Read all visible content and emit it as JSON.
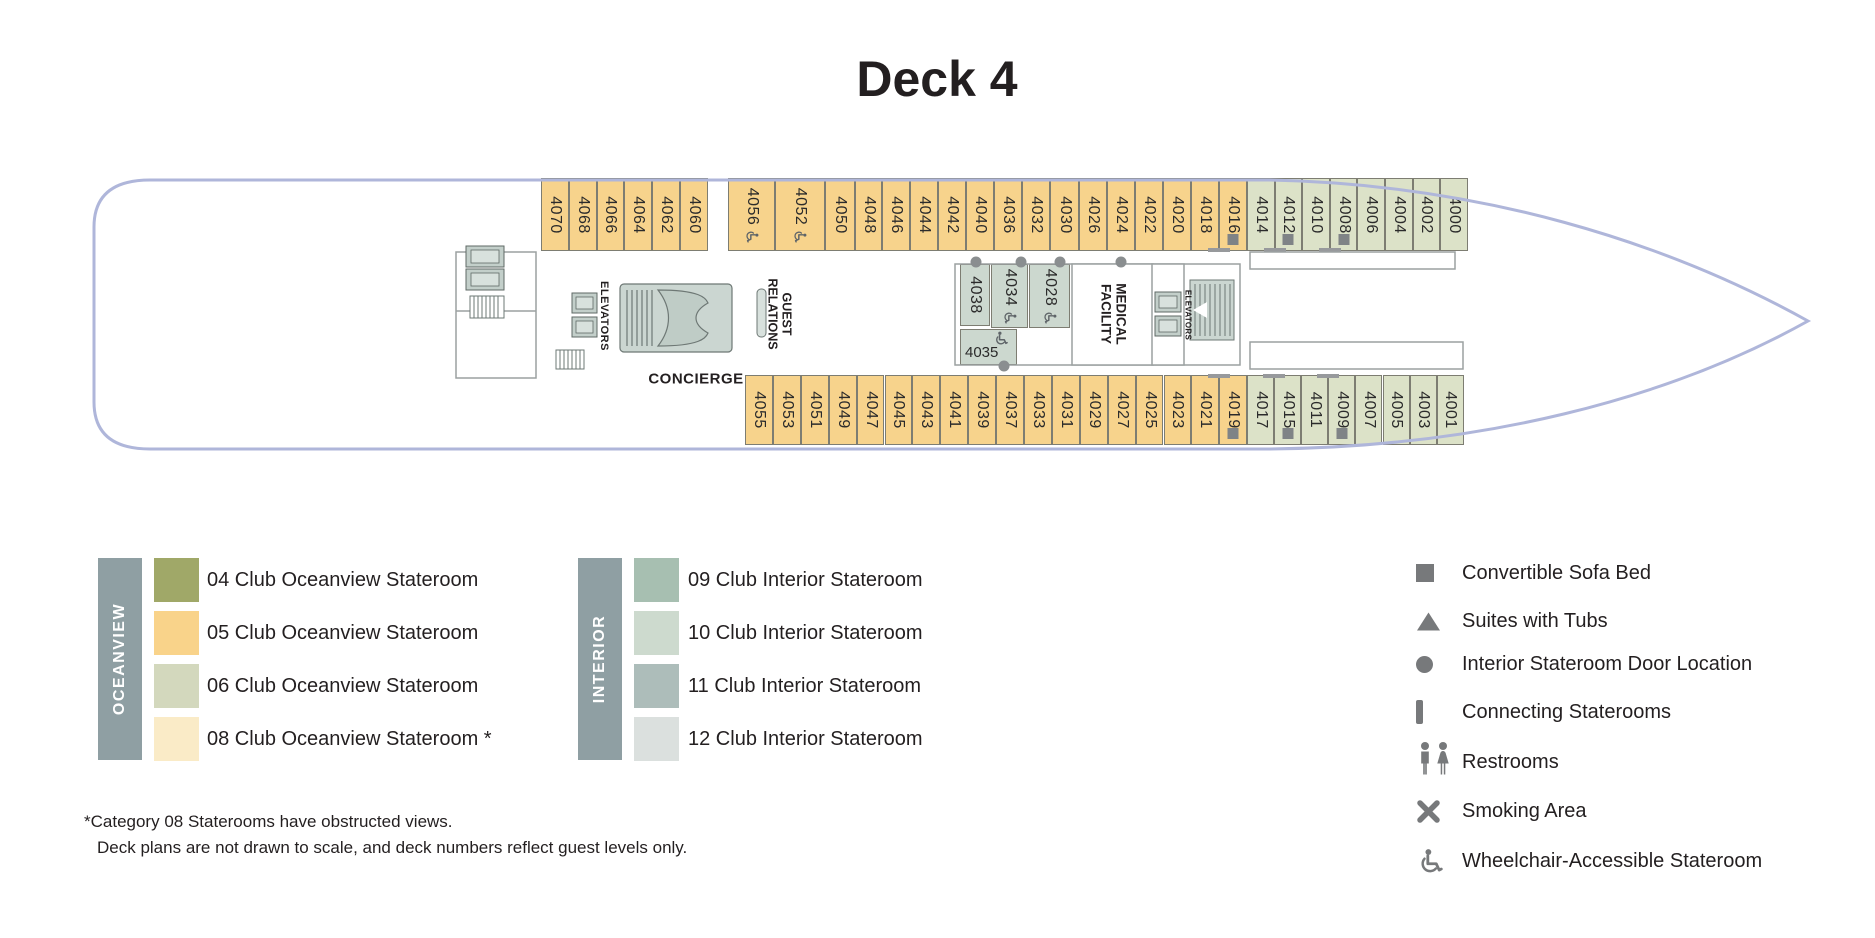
{
  "header": {
    "title": "Deck 4"
  },
  "colors": {
    "cat05": "#F7D38C",
    "cat06": "#DCE2C8",
    "cat10": "#CCD8CF",
    "hull": "#AFB6DA",
    "wall": "#9BA1A1",
    "marker_grey": "#7F8386",
    "legend_grey": "#77797B",
    "group_bar": "#8F9FA3"
  },
  "ship": {
    "labels": {
      "elevators_left": "ELEVATORS",
      "elevators_right": "ELEVATORS",
      "guest_relations": "GUEST RELATIONS",
      "concierge": "CONCIERGE",
      "medical_facility": "MEDICAL FACILITY"
    },
    "top_row_sections": [
      {
        "category": "05",
        "rooms": [
          {
            "number": "4070"
          },
          {
            "number": "4068"
          },
          {
            "number": "4066"
          },
          {
            "number": "4064"
          },
          {
            "number": "4062"
          },
          {
            "number": "4060"
          }
        ]
      },
      {
        "category": "05",
        "rooms": [
          {
            "number": "4056",
            "features": [
              "wheelchair"
            ]
          },
          {
            "number": "4052",
            "features": [
              "wheelchair"
            ]
          },
          {
            "number": "4050"
          },
          {
            "number": "4048"
          }
        ]
      },
      {
        "category": "05",
        "rooms": [
          {
            "number": "4046"
          },
          {
            "number": "4044"
          },
          {
            "number": "4042"
          },
          {
            "number": "4040"
          },
          {
            "number": "4036"
          },
          {
            "number": "4032"
          },
          {
            "number": "4030"
          },
          {
            "number": "4026"
          },
          {
            "number": "4024"
          },
          {
            "number": "4022"
          },
          {
            "number": "4020"
          },
          {
            "number": "4018"
          },
          {
            "number": "4016",
            "features": [
              "sofa",
              "connect-left"
            ]
          }
        ]
      },
      {
        "category": "06",
        "rooms": [
          {
            "number": "4014"
          },
          {
            "number": "4012",
            "features": [
              "sofa",
              "connect-left"
            ]
          },
          {
            "number": "4010"
          },
          {
            "number": "4008",
            "features": [
              "sofa",
              "connect-left"
            ]
          },
          {
            "number": "4006"
          },
          {
            "number": "4004"
          },
          {
            "number": "4002"
          },
          {
            "number": "4000"
          }
        ]
      }
    ],
    "bottom_row_sections": [
      {
        "category": "05",
        "rooms": [
          {
            "number": "4055"
          },
          {
            "number": "4053"
          },
          {
            "number": "4051"
          },
          {
            "number": "4049"
          },
          {
            "number": "4047"
          },
          {
            "number": "4045"
          },
          {
            "number": "4043"
          },
          {
            "number": "4041"
          },
          {
            "number": "4039"
          },
          {
            "number": "4037"
          },
          {
            "number": "4033"
          },
          {
            "number": "4031"
          },
          {
            "number": "4029"
          },
          {
            "number": "4027"
          },
          {
            "number": "4025"
          },
          {
            "number": "4023"
          },
          {
            "number": "4021"
          },
          {
            "number": "4019",
            "features": [
              "sofa",
              "connect-left"
            ]
          }
        ]
      },
      {
        "category": "06",
        "rooms": [
          {
            "number": "4017"
          },
          {
            "number": "4015",
            "features": [
              "sofa",
              "connect-left"
            ]
          },
          {
            "number": "4011"
          },
          {
            "number": "4009",
            "features": [
              "sofa",
              "connect-left"
            ]
          },
          {
            "number": "4007"
          },
          {
            "number": "4005"
          },
          {
            "number": "4003"
          },
          {
            "number": "4001"
          }
        ]
      }
    ],
    "middle_rooms": [
      {
        "number": "4038",
        "features": [
          "door-dot"
        ]
      },
      {
        "number": "4034",
        "features": [
          "wheelchair",
          "door-dot"
        ]
      },
      {
        "number": "4028",
        "features": [
          "wheelchair",
          "door-dot"
        ]
      },
      {
        "number": "4035",
        "features": [
          "wheelchair",
          "door-dot"
        ]
      }
    ]
  },
  "legend": {
    "oceanview": {
      "group_label": "OCEANVIEW",
      "items": [
        {
          "code": "04",
          "label": "04 Club Oceanview Stateroom",
          "color": "#A0A868"
        },
        {
          "code": "05",
          "label": "05 Club Oceanview Stateroom",
          "color": "#F9D38A"
        },
        {
          "code": "06",
          "label": "06 Club Oceanview Stateroom",
          "color": "#D3D8BD"
        },
        {
          "code": "08",
          "label": "08 Club Oceanview Stateroom *",
          "color": "#FAEBC7"
        }
      ]
    },
    "interior": {
      "group_label": "INTERIOR",
      "items": [
        {
          "code": "09",
          "label": "09 Club Interior Stateroom",
          "color": "#A7BFB1"
        },
        {
          "code": "10",
          "label": "10 Club Interior Stateroom",
          "color": "#CDDACE"
        },
        {
          "code": "11",
          "label": "11 Club Interior Stateroom",
          "color": "#ADBDBA"
        },
        {
          "code": "12",
          "label": "12 Club Interior Stateroom",
          "color": "#DBE0DE"
        }
      ]
    },
    "symbols": [
      {
        "icon": "square",
        "label": "Convertible Sofa Bed"
      },
      {
        "icon": "triangle",
        "label": "Suites with Tubs"
      },
      {
        "icon": "circle",
        "label": "Interior Stateroom Door Location"
      },
      {
        "icon": "bar",
        "label": "Connecting Staterooms"
      },
      {
        "icon": "restrooms",
        "label": "Restrooms"
      },
      {
        "icon": "smoking",
        "label": "Smoking Area"
      },
      {
        "icon": "wheelchair",
        "label": "Wheelchair-Accessible Stateroom"
      }
    ]
  },
  "footnotes": [
    "*Category 08 Staterooms have obstructed views.",
    "Deck plans are not drawn to scale, and deck numbers reflect guest levels only."
  ]
}
